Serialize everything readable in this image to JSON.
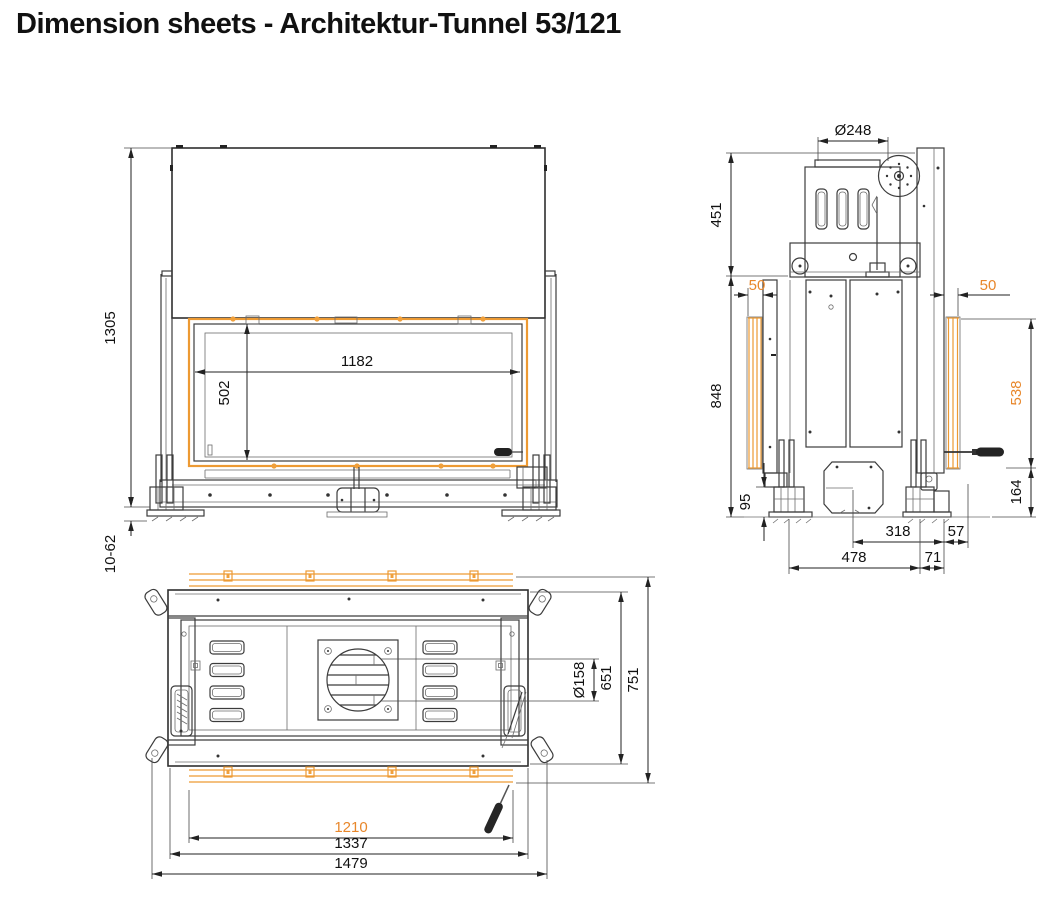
{
  "title": "Dimension sheets - Architektur-Tunnel 53/121",
  "colors": {
    "accent_orange": "#E8872B",
    "strip_orange": "#F0A03C",
    "line_dark": "#3C3C3C"
  },
  "views": {
    "front": {
      "dims": {
        "total_height": "1305",
        "glass_width": "1182",
        "glass_height": "502",
        "foot_adjustment": "10-62"
      }
    },
    "side": {
      "dims": {
        "flue_diameter": "Ø248",
        "upper_section_height": "451",
        "front_frame_overlap": "50",
        "rear_frame_overlap": "50",
        "body_height": "848",
        "frame_height": "538",
        "foot_height": "95",
        "handle_height": "164",
        "air_connector_offset": "318",
        "rear_offset": "57",
        "foot_spacing": "478",
        "rear_foot_offset": "71"
      }
    },
    "bottom": {
      "dims": {
        "air_inlet_diameter": "Ø158",
        "body_depth": "651",
        "total_depth": "751",
        "frame_width": "1210",
        "body_width": "1337",
        "total_width": "1479"
      }
    }
  }
}
